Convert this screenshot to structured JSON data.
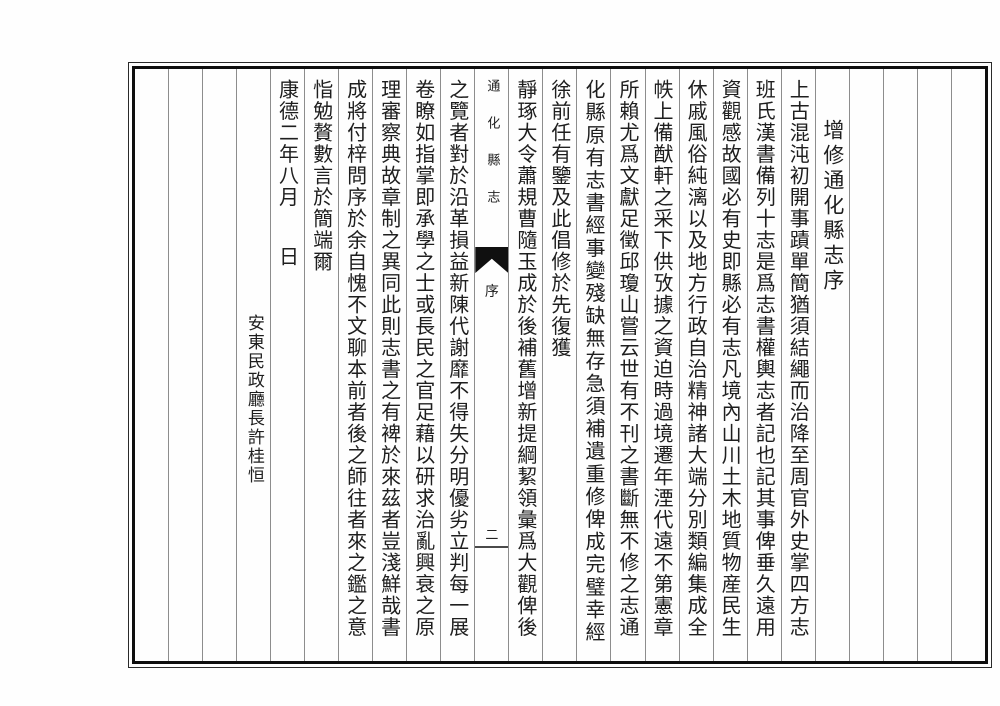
{
  "colors": {
    "ink": "#1e1e1e",
    "paper": "#fefefe",
    "frame": "#0e0e0e",
    "rule": "#8d8d8d"
  },
  "banxin": {
    "book_title": "通化縣志",
    "section": "序",
    "page_number": "二"
  },
  "columns": [
    {
      "role": "empty"
    },
    {
      "role": "empty"
    },
    {
      "role": "empty"
    },
    {
      "role": "empty"
    },
    {
      "role": "title",
      "text": "增修通化縣志序"
    },
    {
      "role": "body",
      "text": "上古混沌初開事蹟單簡猶須結繩而治降至周官外史掌四方志"
    },
    {
      "role": "body",
      "text": "班氏漢書備列十志是爲志書權輿志者記也記其事俾垂久遠用"
    },
    {
      "role": "body",
      "text": "資觀感故國必有史即縣必有志凡境內山川土木地質物産民生"
    },
    {
      "role": "body",
      "text": "休戚風俗純漓以及地方行政自治精神諸大端分別類編集成全"
    },
    {
      "role": "body",
      "text": "帙上備猷軒之采下供攷據之資迫時過境遷年湮代遠不第憲章"
    },
    {
      "role": "body",
      "text": "所賴尤爲文獻足徵邱瓊山嘗云世有不刊之書斷無不修之志通"
    },
    {
      "role": "body",
      "spread": true,
      "text": "化縣原有志書經事變殘缺無存急須補遺重修俾成完璧幸經"
    },
    {
      "role": "body",
      "text": "徐前任有鑒及此倡修於先復獲"
    },
    {
      "role": "body",
      "text": "靜琢大令蕭規曹隨玉成於後補舊增新提綱絜領彙爲大觀俾後"
    },
    {
      "role": "center"
    },
    {
      "role": "body",
      "text": "之覽者對於沿革損益新陳代謝靡不得失分明優劣立判每一展"
    },
    {
      "role": "body",
      "text": "卷瞭如指掌即承學之士或長民之官足藉以研求治亂興衰之原"
    },
    {
      "role": "body",
      "text": "理審察典故章制之異同此則志書之有裨於來茲者豈淺鮮哉書"
    },
    {
      "role": "body",
      "text": "成將付梓問序於余自愧不文聊本前者後之師往者來之鑑之意"
    },
    {
      "role": "body",
      "text": "恉勉贅數言於簡端爾"
    },
    {
      "role": "date",
      "text_top": "康德二年八月",
      "text_bottom": "日"
    },
    {
      "role": "signature",
      "text": "安東民政廳長許桂恒"
    },
    {
      "role": "empty"
    },
    {
      "role": "empty"
    },
    {
      "role": "empty"
    }
  ]
}
